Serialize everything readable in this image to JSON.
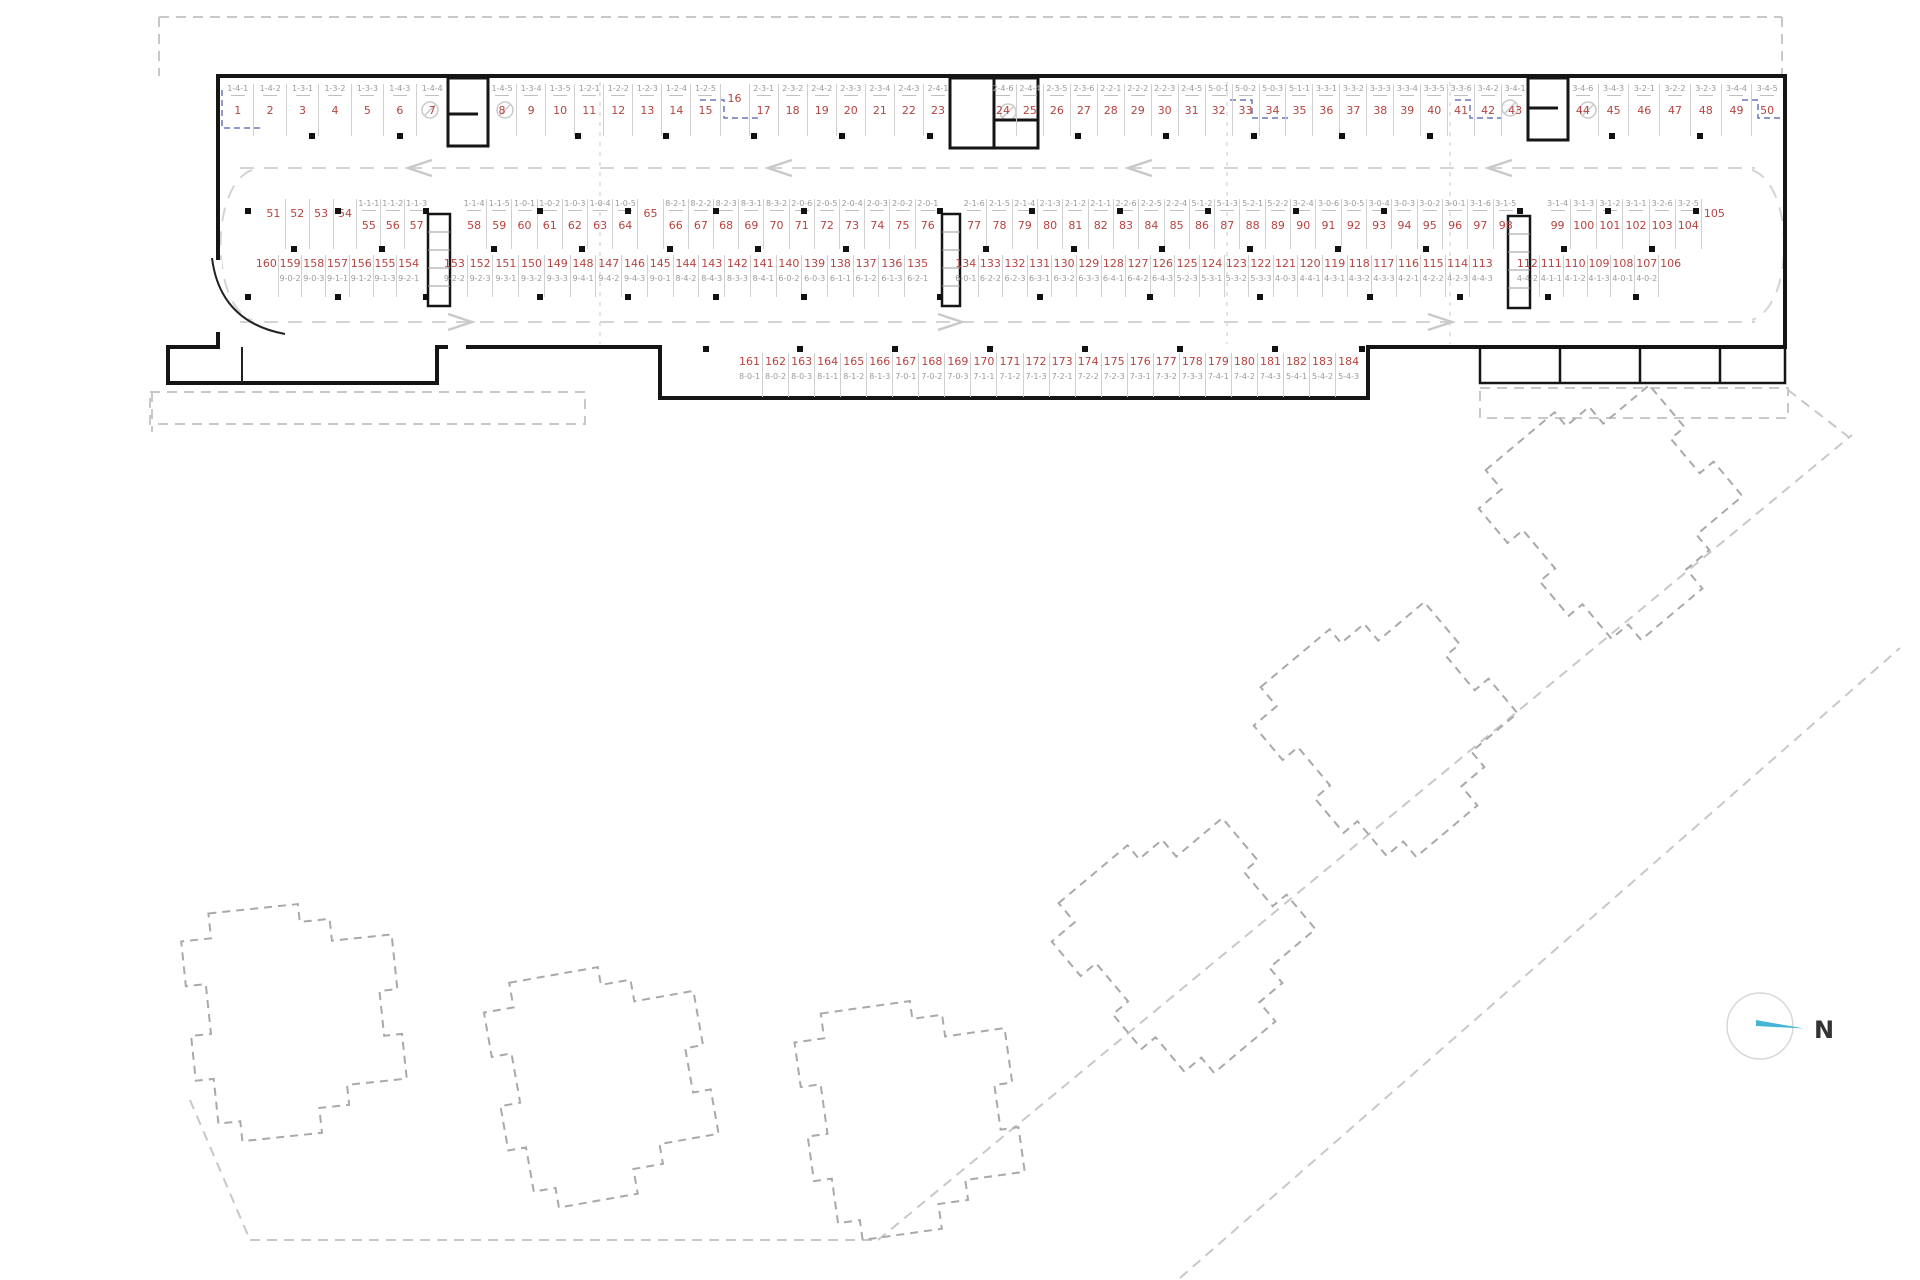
{
  "compass": {
    "label": "N"
  },
  "colors": {
    "space_number": "#b5433f",
    "code_text": "#9a9a9a",
    "needle": "#45b6d8",
    "wall": "#151515"
  },
  "plan": {
    "rows": [
      {
        "groups": [
          {
            "spaces": [
              {
                "n": 1,
                "c": "1-4-1"
              },
              {
                "n": 2,
                "c": "1-4-2"
              },
              {
                "n": 3,
                "c": "1-3-1"
              },
              {
                "n": 4,
                "c": "1-3-2"
              },
              {
                "n": 5,
                "c": "1-3-3"
              },
              {
                "n": 6,
                "c": "1-4-3"
              },
              {
                "n": 7,
                "c": "1-4-4"
              }
            ]
          },
          {
            "spaces": [
              {
                "n": 8,
                "c": "1-4-5"
              },
              {
                "n": 9,
                "c": "1-3-4"
              },
              {
                "n": 10,
                "c": "1-3-5"
              },
              {
                "n": 11,
                "c": "1-2-1"
              },
              {
                "n": 12,
                "c": "1-2-2"
              },
              {
                "n": 13,
                "c": "1-2-3"
              },
              {
                "n": 14,
                "c": "1-2-4"
              },
              {
                "n": 15,
                "c": "1-2-5"
              },
              {
                "n": 16,
                "c": ""
              },
              {
                "n": 17,
                "c": "2-3-1"
              },
              {
                "n": 18,
                "c": "2-3-2"
              },
              {
                "n": 19,
                "c": "2-4-2"
              },
              {
                "n": 20,
                "c": "2-3-3"
              },
              {
                "n": 21,
                "c": "2-3-4"
              },
              {
                "n": 22,
                "c": "2-4-3"
              },
              {
                "n": 23,
                "c": "2-4-1"
              }
            ]
          },
          {
            "spaces": [
              {
                "n": 24,
                "c": "2-4-6"
              },
              {
                "n": 25,
                "c": "2-4-4"
              },
              {
                "n": 26,
                "c": "2-3-5"
              },
              {
                "n": 27,
                "c": "2-3-6"
              },
              {
                "n": 28,
                "c": "2-2-1"
              },
              {
                "n": 29,
                "c": "2-2-2"
              },
              {
                "n": 30,
                "c": "2-2-3"
              },
              {
                "n": 31,
                "c": "2-4-5"
              },
              {
                "n": 32,
                "c": "5-0-1"
              },
              {
                "n": 33,
                "c": "5-0-2"
              },
              {
                "n": 34,
                "c": "5-0-3"
              },
              {
                "n": 35,
                "c": "5-1-1"
              },
              {
                "n": 36,
                "c": "3-3-1"
              },
              {
                "n": 37,
                "c": "3-3-2"
              },
              {
                "n": 38,
                "c": "3-3-3"
              },
              {
                "n": 39,
                "c": "3-3-4"
              },
              {
                "n": 40,
                "c": "3-3-5"
              },
              {
                "n": 41,
                "c": "3-3-6"
              },
              {
                "n": 42,
                "c": "3-4-2"
              },
              {
                "n": 43,
                "c": "3-4-1"
              }
            ]
          },
          {
            "spaces": [
              {
                "n": 44,
                "c": "3-4-6"
              },
              {
                "n": 45,
                "c": "3-4-3"
              },
              {
                "n": 46,
                "c": "3-2-1"
              },
              {
                "n": 47,
                "c": "3-2-2"
              },
              {
                "n": 48,
                "c": "3-2-3"
              },
              {
                "n": 49,
                "c": "3-4-4"
              },
              {
                "n": 50,
                "c": "3-4-5"
              }
            ]
          }
        ]
      },
      {
        "groups": [
          {
            "spaces": [
              {
                "n": 51,
                "c": ""
              },
              {
                "n": 52,
                "c": ""
              },
              {
                "n": 53,
                "c": ""
              },
              {
                "n": 54,
                "c": ""
              },
              {
                "n": 55,
                "c": "1-1-1"
              },
              {
                "n": 56,
                "c": "1-1-2"
              },
              {
                "n": 57,
                "c": "1-1-3"
              }
            ]
          },
          {
            "spaces": [
              {
                "n": 58,
                "c": "1-1-4"
              },
              {
                "n": 59,
                "c": "1-1-5"
              },
              {
                "n": 60,
                "c": "1-0-1"
              },
              {
                "n": 61,
                "c": "1-0-2"
              },
              {
                "n": 62,
                "c": "1-0-3"
              },
              {
                "n": 63,
                "c": "1-0-4"
              },
              {
                "n": 64,
                "c": "1-0-5"
              },
              {
                "n": 65,
                "c": ""
              },
              {
                "n": 66,
                "c": "8-2-1"
              },
              {
                "n": 67,
                "c": "8-2-2"
              },
              {
                "n": 68,
                "c": "8-2-3"
              },
              {
                "n": 69,
                "c": "8-3-1"
              },
              {
                "n": 70,
                "c": "8-3-2"
              },
              {
                "n": 71,
                "c": "2-0-6"
              },
              {
                "n": 72,
                "c": "2-0-5"
              },
              {
                "n": 73,
                "c": "2-0-4"
              },
              {
                "n": 74,
                "c": "2-0-3"
              },
              {
                "n": 75,
                "c": "2-0-2"
              },
              {
                "n": 76,
                "c": "2-0-1"
              }
            ]
          },
          {
            "spaces": [
              {
                "n": 77,
                "c": "2-1-6"
              },
              {
                "n": 78,
                "c": "2-1-5"
              },
              {
                "n": 79,
                "c": "2-1-4"
              },
              {
                "n": 80,
                "c": "2-1-3"
              },
              {
                "n": 81,
                "c": "2-1-2"
              },
              {
                "n": 82,
                "c": "2-1-1"
              },
              {
                "n": 83,
                "c": "2-2-6"
              },
              {
                "n": 84,
                "c": "2-2-5"
              },
              {
                "n": 85,
                "c": "2-2-4"
              },
              {
                "n": 86,
                "c": "5-1-2"
              },
              {
                "n": 87,
                "c": "5-1-3"
              },
              {
                "n": 88,
                "c": "5-2-1"
              },
              {
                "n": 89,
                "c": "5-2-2"
              },
              {
                "n": 90,
                "c": "3-2-4"
              },
              {
                "n": 91,
                "c": "3-0-6"
              },
              {
                "n": 92,
                "c": "3-0-5"
              },
              {
                "n": 93,
                "c": "3-0-4"
              },
              {
                "n": 94,
                "c": "3-0-3"
              },
              {
                "n": 95,
                "c": "3-0-2"
              },
              {
                "n": 96,
                "c": "3-0-1"
              },
              {
                "n": 97,
                "c": "3-1-6"
              },
              {
                "n": 98,
                "c": "3-1-5"
              }
            ]
          },
          {
            "spaces": [
              {
                "n": 99,
                "c": "3-1-4"
              },
              {
                "n": 100,
                "c": "3-1-3"
              },
              {
                "n": 101,
                "c": "3-1-2"
              },
              {
                "n": 102,
                "c": "3-1-1"
              },
              {
                "n": 103,
                "c": "3-2-6"
              },
              {
                "n": 104,
                "c": "3-2-5"
              },
              {
                "n": 105,
                "c": ""
              }
            ]
          }
        ]
      },
      {
        "groups": [
          {
            "spaces": [
              {
                "n": 160,
                "c": ""
              },
              {
                "n": 159,
                "c": "9-0-2"
              },
              {
                "n": 158,
                "c": "9-0-3"
              },
              {
                "n": 157,
                "c": "9-1-1"
              },
              {
                "n": 156,
                "c": "9-1-2"
              },
              {
                "n": 155,
                "c": "9-1-3"
              },
              {
                "n": 154,
                "c": "9-2-1"
              }
            ]
          },
          {
            "spaces": [
              {
                "n": 153,
                "c": "9-2-2"
              },
              {
                "n": 152,
                "c": "9-2-3"
              },
              {
                "n": 151,
                "c": "9-3-1"
              },
              {
                "n": 150,
                "c": "9-3-2"
              },
              {
                "n": 149,
                "c": "9-3-3"
              },
              {
                "n": 148,
                "c": "9-4-1"
              },
              {
                "n": 147,
                "c": "9-4-2"
              },
              {
                "n": 146,
                "c": "9-4-3"
              },
              {
                "n": 145,
                "c": "9-0-1"
              },
              {
                "n": 144,
                "c": "8-4-2"
              },
              {
                "n": 143,
                "c": "8-4-3"
              },
              {
                "n": 142,
                "c": "8-3-3"
              },
              {
                "n": 141,
                "c": "8-4-1"
              },
              {
                "n": 140,
                "c": "6-0-2"
              },
              {
                "n": 139,
                "c": "6-0-3"
              },
              {
                "n": 138,
                "c": "6-1-1"
              },
              {
                "n": 137,
                "c": "6-1-2"
              },
              {
                "n": 136,
                "c": "6-1-3"
              },
              {
                "n": 135,
                "c": "6-2-1"
              }
            ]
          },
          {
            "spaces": [
              {
                "n": 134,
                "c": "6-0-1"
              },
              {
                "n": 133,
                "c": "6-2-2"
              },
              {
                "n": 132,
                "c": "6-2-3"
              },
              {
                "n": 131,
                "c": "6-3-1"
              },
              {
                "n": 130,
                "c": "6-3-2"
              },
              {
                "n": 129,
                "c": "6-3-3"
              },
              {
                "n": 128,
                "c": "6-4-1"
              },
              {
                "n": 127,
                "c": "6-4-2"
              },
              {
                "n": 126,
                "c": "6-4-3"
              },
              {
                "n": 125,
                "c": "5-2-3"
              },
              {
                "n": 124,
                "c": "5-3-1"
              },
              {
                "n": 123,
                "c": "5-3-2"
              },
              {
                "n": 122,
                "c": "5-3-3"
              },
              {
                "n": 121,
                "c": "4-0-3"
              },
              {
                "n": 120,
                "c": "4-4-1"
              },
              {
                "n": 119,
                "c": "4-3-1"
              },
              {
                "n": 118,
                "c": "4-3-2"
              },
              {
                "n": 117,
                "c": "4-3-3"
              },
              {
                "n": 116,
                "c": "4-2-1"
              },
              {
                "n": 115,
                "c": "4-2-2"
              },
              {
                "n": 114,
                "c": "4-2-3"
              },
              {
                "n": 113,
                "c": "4-4-3"
              }
            ]
          },
          {
            "spaces": [
              {
                "n": 112,
                "c": "4-4-2"
              },
              {
                "n": 111,
                "c": "4-1-1"
              },
              {
                "n": 110,
                "c": "4-1-2"
              },
              {
                "n": 109,
                "c": "4-1-3"
              },
              {
                "n": 108,
                "c": "4-0-1"
              },
              {
                "n": 107,
                "c": "4-0-2"
              },
              {
                "n": 106,
                "c": ""
              }
            ]
          }
        ]
      },
      {
        "groups": [
          {
            "spaces": [
              {
                "n": 161,
                "c": "8-0-1"
              },
              {
                "n": 162,
                "c": "8-0-2"
              },
              {
                "n": 163,
                "c": "8-0-3"
              },
              {
                "n": 164,
                "c": "8-1-1"
              },
              {
                "n": 165,
                "c": "8-1-2"
              },
              {
                "n": 166,
                "c": "8-1-3"
              },
              {
                "n": 167,
                "c": "7-0-1"
              },
              {
                "n": 168,
                "c": "7-0-2"
              },
              {
                "n": 169,
                "c": "7-0-3"
              },
              {
                "n": 170,
                "c": "7-1-1"
              },
              {
                "n": 171,
                "c": "7-1-2"
              },
              {
                "n": 172,
                "c": "7-1-3"
              },
              {
                "n": 173,
                "c": "7-2-1"
              },
              {
                "n": 174,
                "c": "7-2-2"
              },
              {
                "n": 175,
                "c": "7-2-3"
              },
              {
                "n": 176,
                "c": "7-3-1"
              },
              {
                "n": 177,
                "c": "7-3-2"
              },
              {
                "n": 178,
                "c": "7-3-3"
              },
              {
                "n": 179,
                "c": "7-4-1"
              },
              {
                "n": 180,
                "c": "7-4-2"
              },
              {
                "n": 181,
                "c": "7-4-3"
              },
              {
                "n": 182,
                "c": "5-4-1"
              },
              {
                "n": 183,
                "c": "5-4-2"
              },
              {
                "n": 184,
                "c": "5-4-3"
              }
            ]
          }
        ]
      }
    ]
  }
}
